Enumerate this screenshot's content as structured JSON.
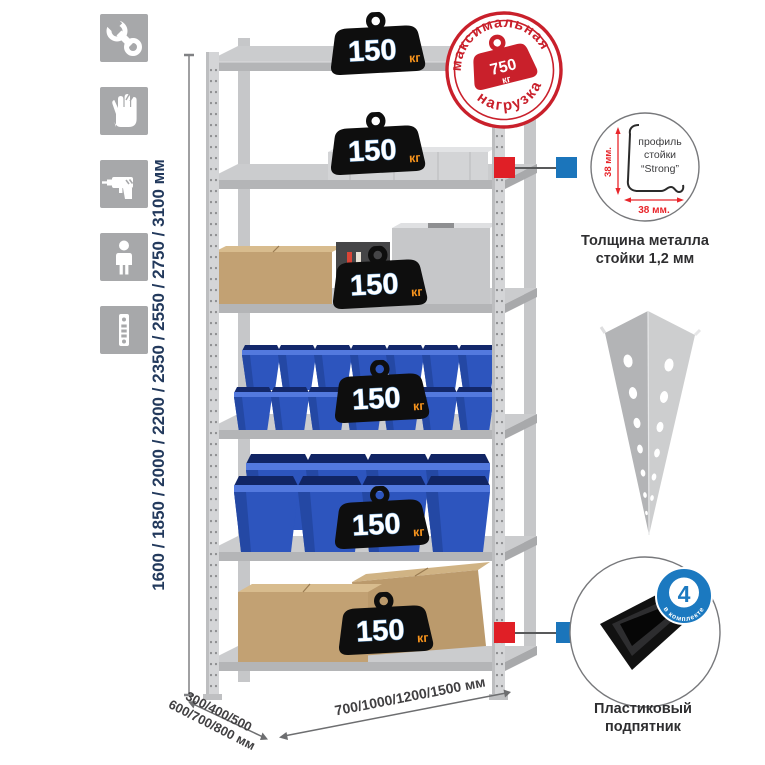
{
  "left_icons": [
    {
      "name": "wrench-icon"
    },
    {
      "name": "gloves-icon"
    },
    {
      "name": "drill-icon"
    },
    {
      "name": "person-icon"
    },
    {
      "name": "perforated-post-icon"
    }
  ],
  "height_dimension": {
    "label": "1600 / 1850 / 2000 / 2200 / 2350 / 2550 / 2750 / 3100 мм"
  },
  "depth_dimension": {
    "line1": "300/400/500",
    "line2": "600/700/800 мм"
  },
  "width_dimension": {
    "label": "700/1000/1200/1500 мм"
  },
  "shelf_loads": [
    {
      "value": "150",
      "unit": "кг"
    },
    {
      "value": "150",
      "unit": "кг"
    },
    {
      "value": "150",
      "unit": "кг"
    },
    {
      "value": "150",
      "unit": "кг"
    },
    {
      "value": "150",
      "unit": "кг"
    },
    {
      "value": "150",
      "unit": "кг"
    }
  ],
  "max_load_stamp": {
    "top_text": "максимальная",
    "bottom_text": "нагрузка",
    "weight_value": "750",
    "weight_unit": "кг"
  },
  "profile_detail": {
    "dim_vertical": "38 мм.",
    "dim_horizontal": "38 мм.",
    "label_line1": "профиль",
    "label_line2": "стойки",
    "label_line3": "“Strong”",
    "caption_line1": "Толщина металла",
    "caption_line2": "стойки 1,2 мм"
  },
  "foot_detail": {
    "badge_value": "4",
    "badge_text": "в комплекте",
    "caption_line1": "Пластиковый",
    "caption_line2": "подпятник"
  },
  "colors": {
    "accent_red": "#e01f26",
    "accent_blue": "#1b75bb",
    "stamp_red": "#c9202b",
    "dimension_navy": "#22395c",
    "bin_blue": "#2d55be",
    "kg_orange": "#f7941d",
    "icon_gray": "#a7a8aa"
  }
}
